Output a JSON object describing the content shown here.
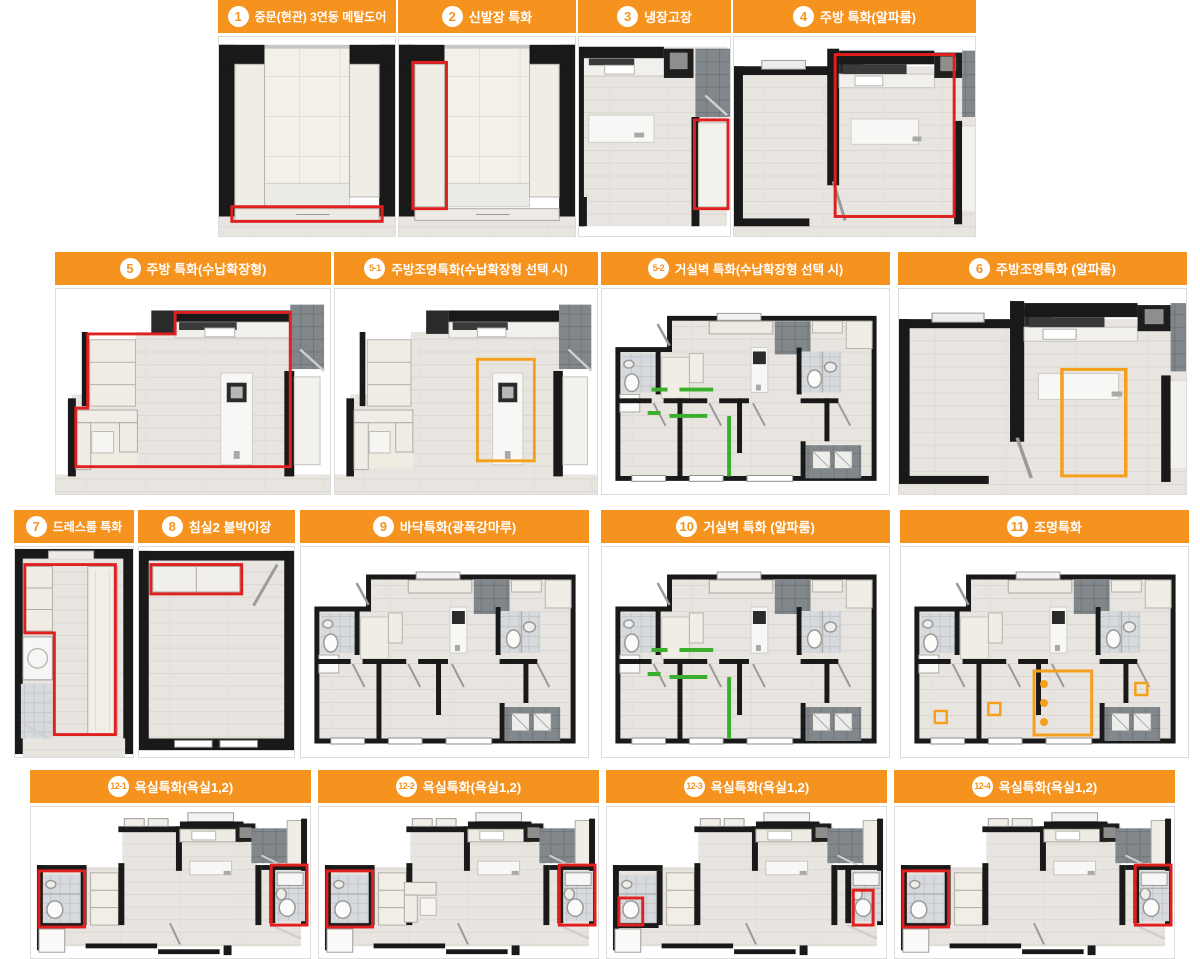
{
  "theme": {
    "header_orange": "#F6921E",
    "highlight_red": "#E01F1F",
    "highlight_orange": "#F5A01C",
    "highlight_green": "#3CAE2E",
    "wall_black": "#191919"
  },
  "board_name": "아파트 유상옵션 특화 평면도",
  "panels": [
    {
      "id": "p1",
      "badge": "1",
      "label": "중문(현관) 3연동 메탈도어",
      "scene": "entrance",
      "highlight": "door-red"
    },
    {
      "id": "p2",
      "badge": "2",
      "label": "신발장 특화",
      "scene": "entrance",
      "highlight": "shoe-red"
    },
    {
      "id": "p3",
      "badge": "3",
      "label": "냉장고장",
      "scene": "kitchen-small",
      "highlight": "fridge-red"
    },
    {
      "id": "p4",
      "badge": "4",
      "label": "주방 특화(알파룸)",
      "scene": "alpha-kitchen",
      "highlight": "kitchen-red"
    },
    {
      "id": "p5",
      "badge": "5",
      "label": "주방 특화(수납확장형)",
      "scene": "storage-kitchen",
      "highlight": "outline-red"
    },
    {
      "id": "p5_1",
      "badge": "5-1",
      "label": "주방조명특화(수납확장형 선택 시)",
      "scene": "storage-kitchen",
      "highlight": "lighting-orange"
    },
    {
      "id": "p5_2",
      "badge": "5-2",
      "label": "거실벽 특화(수납확장형 선택 시)",
      "scene": "full-plan",
      "highlight": "walls-green"
    },
    {
      "id": "p6",
      "badge": "6",
      "label": "주방조명특화 (알파룸)",
      "scene": "alpha-kitchen",
      "highlight": "lighting-orange"
    },
    {
      "id": "p7",
      "badge": "7",
      "label": "드레스룸 특화",
      "scene": "dressroom",
      "highlight": "outline-red"
    },
    {
      "id": "p8",
      "badge": "8",
      "label": "침실2 붙박이장",
      "scene": "bedroom",
      "highlight": "closet-red"
    },
    {
      "id": "p9",
      "badge": "9",
      "label": "바닥특화(광폭강마루)",
      "scene": "full-plan",
      "highlight": "none"
    },
    {
      "id": "p10",
      "badge": "10",
      "label": "거실벽 특화 (알파룸)",
      "scene": "full-plan",
      "highlight": "walls-green"
    },
    {
      "id": "p11",
      "badge": "11",
      "label": "조명특화",
      "scene": "full-plan",
      "highlight": "lighting-orange-squares"
    },
    {
      "id": "p12_1",
      "badge": "12-1",
      "label": "욕실특화(욕실1,2)",
      "scene": "bath-row",
      "highlight": "bath-full-red",
      "variant": "a"
    },
    {
      "id": "p12_2",
      "badge": "12-2",
      "label": "욕실특화(욕실1,2)",
      "scene": "bath-row",
      "highlight": "bath-full-red",
      "variant": "b"
    },
    {
      "id": "p12_3",
      "badge": "12-3",
      "label": "욕실특화(욕실1,2)",
      "scene": "bath-row",
      "highlight": "bath-small-red",
      "variant": "a"
    },
    {
      "id": "p12_4",
      "badge": "12-4",
      "label": "욕실특화(욕실1,2)",
      "scene": "bath-row",
      "highlight": "bath-full-red",
      "variant": "a"
    }
  ]
}
